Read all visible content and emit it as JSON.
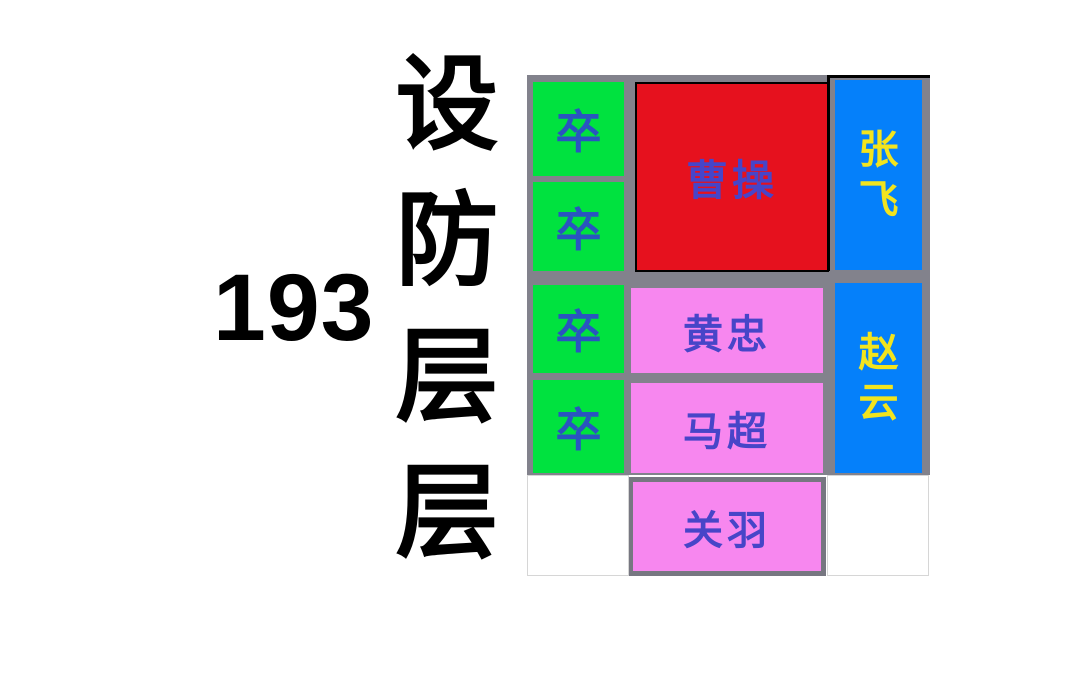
{
  "title": {
    "number": "193",
    "name": "设防层层",
    "name_chars": [
      "设",
      "防",
      "层",
      "层"
    ]
  },
  "board": {
    "soldiers": [
      {
        "label": "卒"
      },
      {
        "label": "卒"
      },
      {
        "label": "卒"
      },
      {
        "label": "卒"
      }
    ],
    "caocao": {
      "label": "曹操"
    },
    "zhangfei": {
      "label": "张飞",
      "chars": [
        "张",
        "飞"
      ]
    },
    "zhaoyun": {
      "label": "赵云",
      "chars": [
        "赵",
        "云"
      ]
    },
    "huangzhong": {
      "label": "黄忠"
    },
    "machao": {
      "label": "马超"
    },
    "guanyu": {
      "label": "关羽"
    }
  },
  "colors": {
    "page_background": "#FFFFFF",
    "board_background": "#82828C",
    "soldier_block": "#00E23F",
    "soldier_text": "#2A54C0",
    "caocao_block": "#E6111E",
    "vertical_block": "#0580FA",
    "vertical_text": "#F2E41E",
    "horizontal_block": "#F787EF",
    "general_text": "#4745C8",
    "highlight_border": "#000000",
    "title_text": "#000000"
  }
}
